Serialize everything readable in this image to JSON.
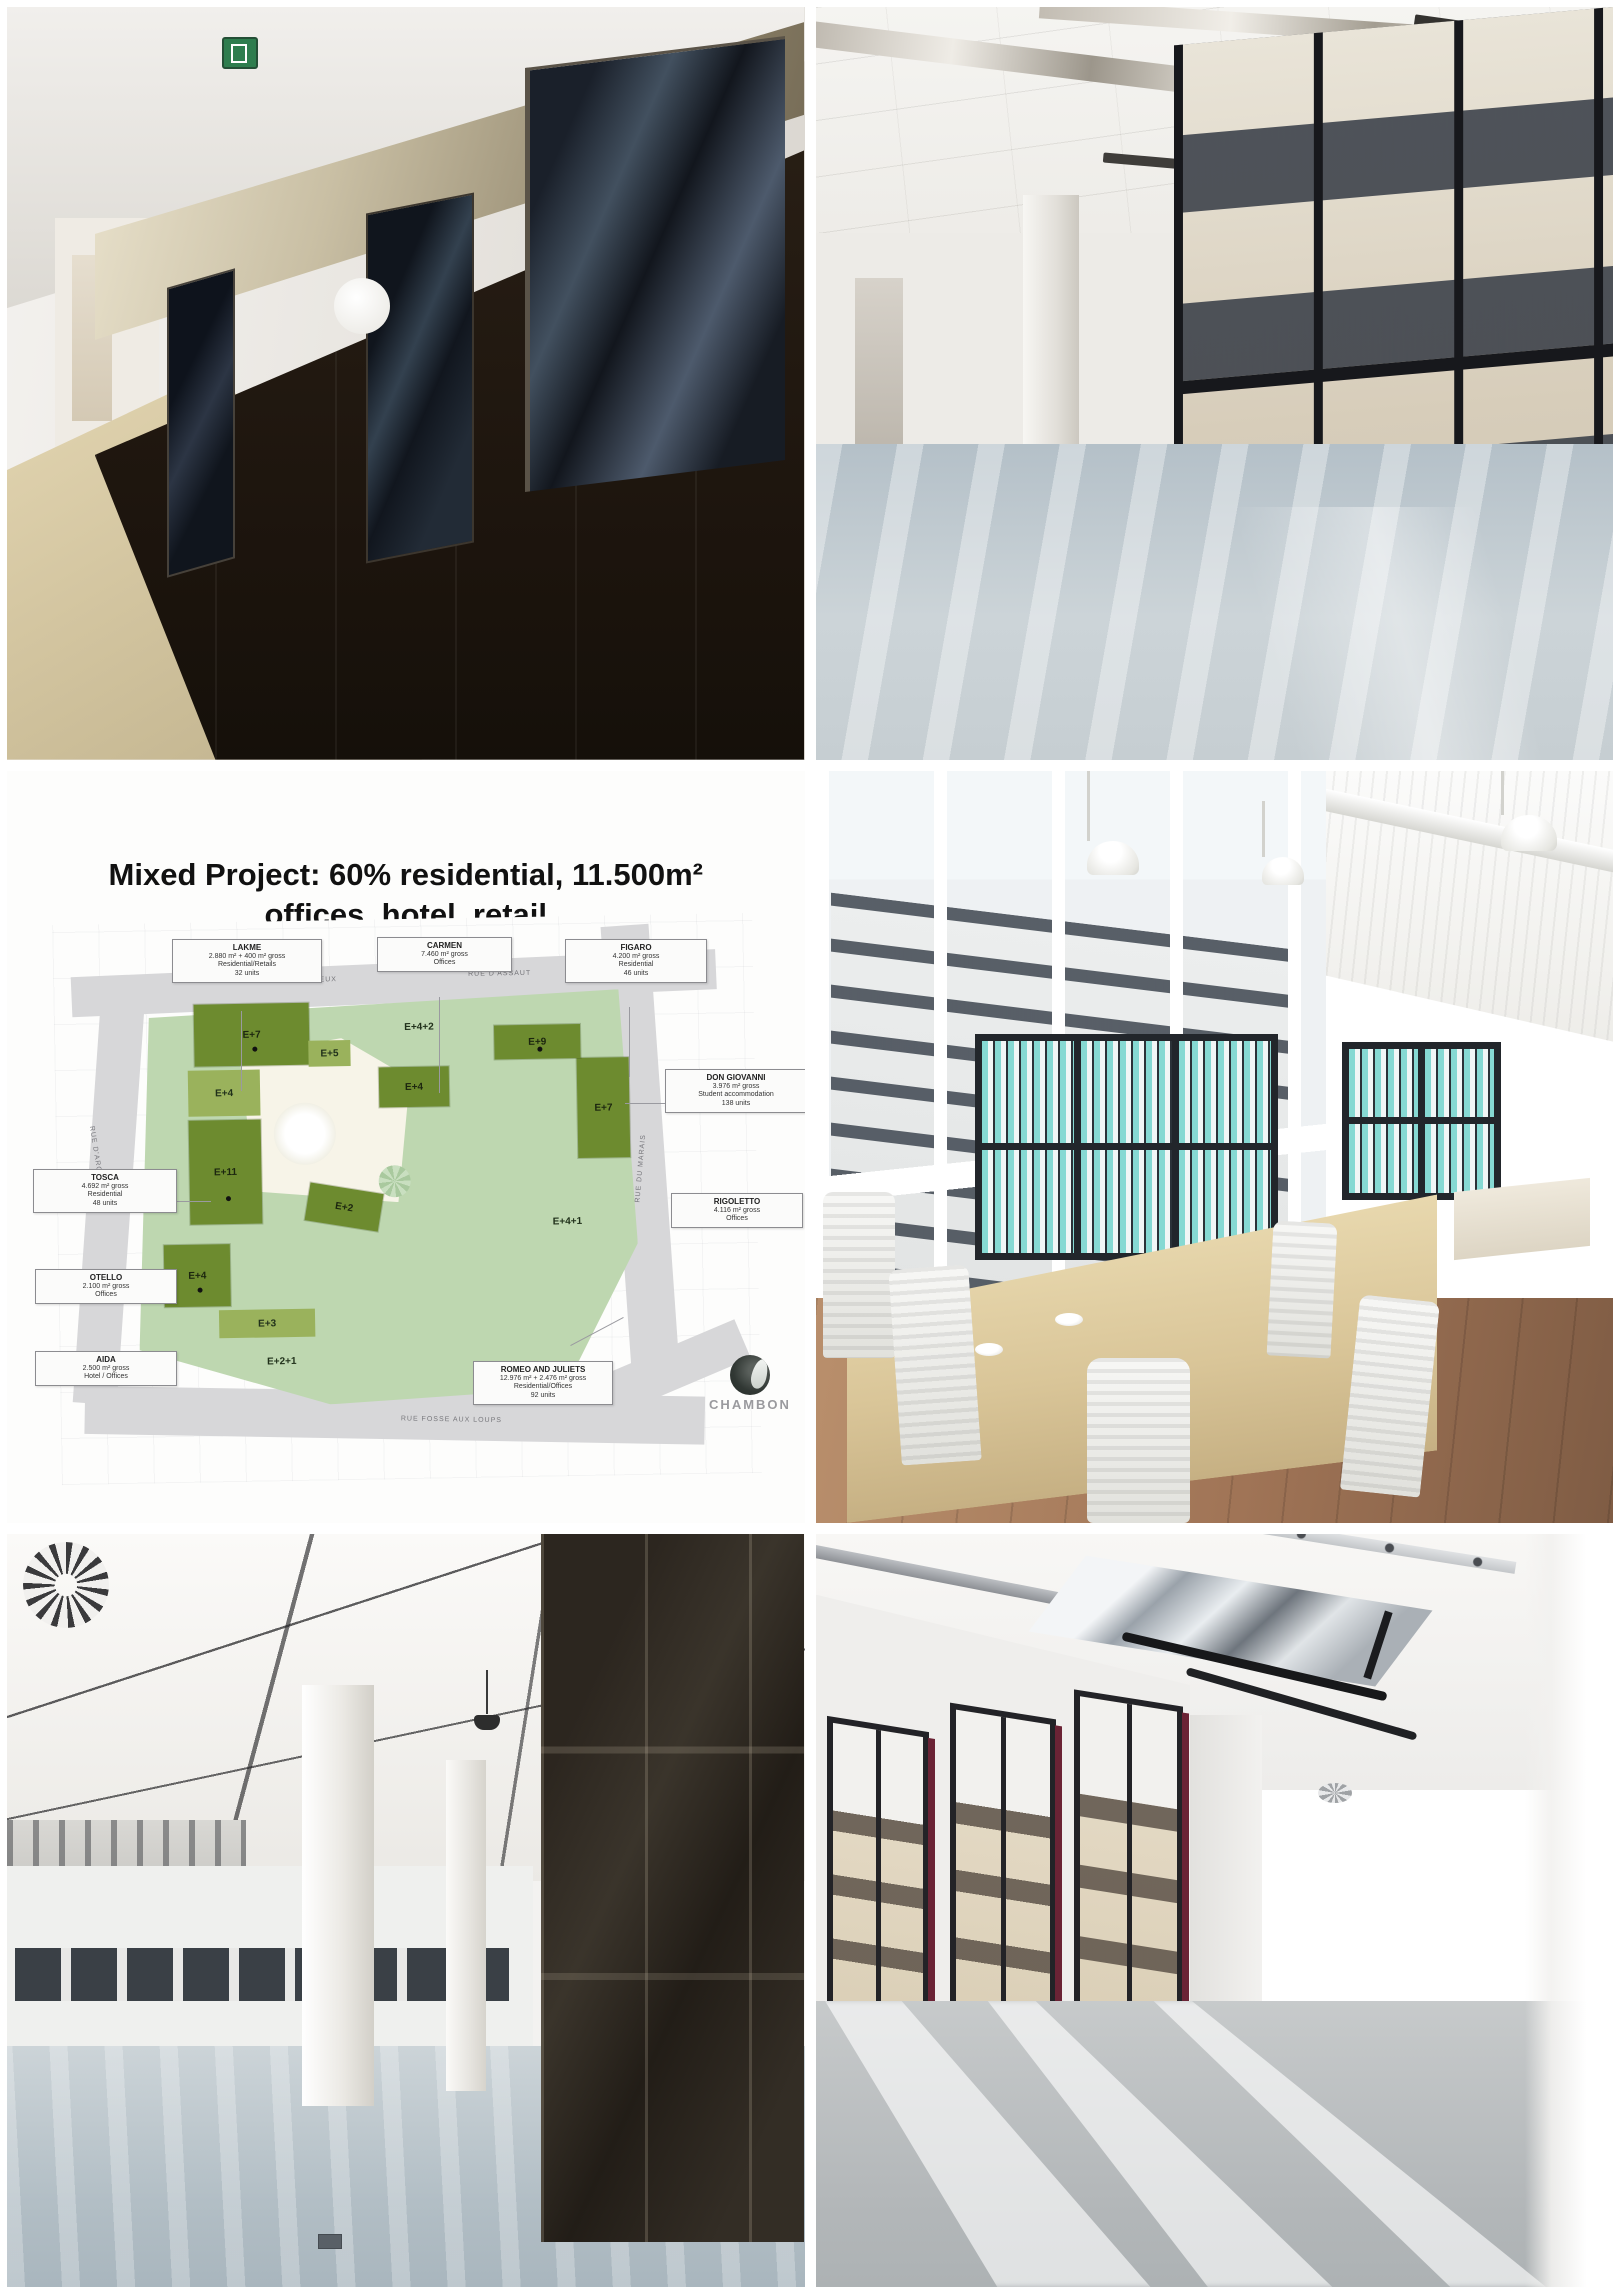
{
  "collage": {
    "photos": {
      "corridor": {
        "description": "Corridor with dark wood wall panels, glass doors, metallic header band, white porthole circle and green exit sign"
      },
      "open_office": {
        "description": "Empty open-plan office floor with mirrored ceiling strips, black-framed window wall and city view"
      },
      "furnished_office": {
        "description": "Rendered office interior with beige desks, white ribbed chairs, black shelves of teal binders, pendant lamps and wood floor"
      },
      "office_columns": {
        "description": "Empty office floor with white tile ceiling, spiral diffuser, white columns and dark bronze glazed wall"
      },
      "office_sunlight": {
        "description": "Empty office with exposed ceiling services, chrome panels, windows with maroon reveals and sunlight stripes on the floor"
      }
    }
  },
  "site_plan": {
    "title": "Mixed Project: 60% residential, 11.500m² offices, hotel, retail",
    "developer_logo": "CHAMBON",
    "buildings": [
      {
        "name": "LAKME",
        "line1": "2.880 m² + 400 m² gross",
        "line2": "Residential/Retails",
        "line3": "32 units"
      },
      {
        "name": "CARMEN",
        "line1": "7.460 m² gross",
        "line2": "Offices",
        "line3": ""
      },
      {
        "name": "FIGARO",
        "line1": "4.200 m² gross",
        "line2": "Residential",
        "line3": "46 units"
      },
      {
        "name": "DON GIOVANNI",
        "line1": "3.976 m² gross",
        "line2": "Student accommodation",
        "line3": "138 units"
      },
      {
        "name": "RIGOLETTO",
        "line1": "4.116 m² gross",
        "line2": "Offices",
        "line3": ""
      },
      {
        "name": "TOSCA",
        "line1": "4.692 m² gross",
        "line2": "Residential",
        "line3": "48 units"
      },
      {
        "name": "OTELLO",
        "line1": "2.100 m² gross",
        "line2": "Offices",
        "line3": ""
      },
      {
        "name": "AIDA",
        "line1": "2.500 m² gross",
        "line2": "Hotel / Offices",
        "line3": ""
      },
      {
        "name": "ROMEO AND JULIETS",
        "line1": "12.976 m² + 2.476 m² gross",
        "line2": "Residential/Offices",
        "line3": "92 units"
      }
    ],
    "blocks": [
      {
        "label": "E+7"
      },
      {
        "label": "E+4"
      },
      {
        "label": "E+11"
      },
      {
        "label": "E+5"
      },
      {
        "label": "E+4+2"
      },
      {
        "label": "E+4"
      },
      {
        "label": "E+7"
      },
      {
        "label": "E+9"
      },
      {
        "label": "E+2"
      },
      {
        "label": "E+4+1"
      },
      {
        "label": "E+4"
      },
      {
        "label": "E+3"
      },
      {
        "label": "E+2+1"
      }
    ],
    "streets": [
      "RUE DES BOITEUX",
      "RUE D'ASSAUT",
      "RUE D'ARGENT",
      "RUE DU MARAIS",
      "RUE FOSSE AUX LOUPS"
    ],
    "colors": {
      "dark_green": "#6d8b2f",
      "medium_green": "#9ab25c",
      "sage_green": "#bed7b0",
      "street_grey": "#d7d7d9"
    }
  }
}
